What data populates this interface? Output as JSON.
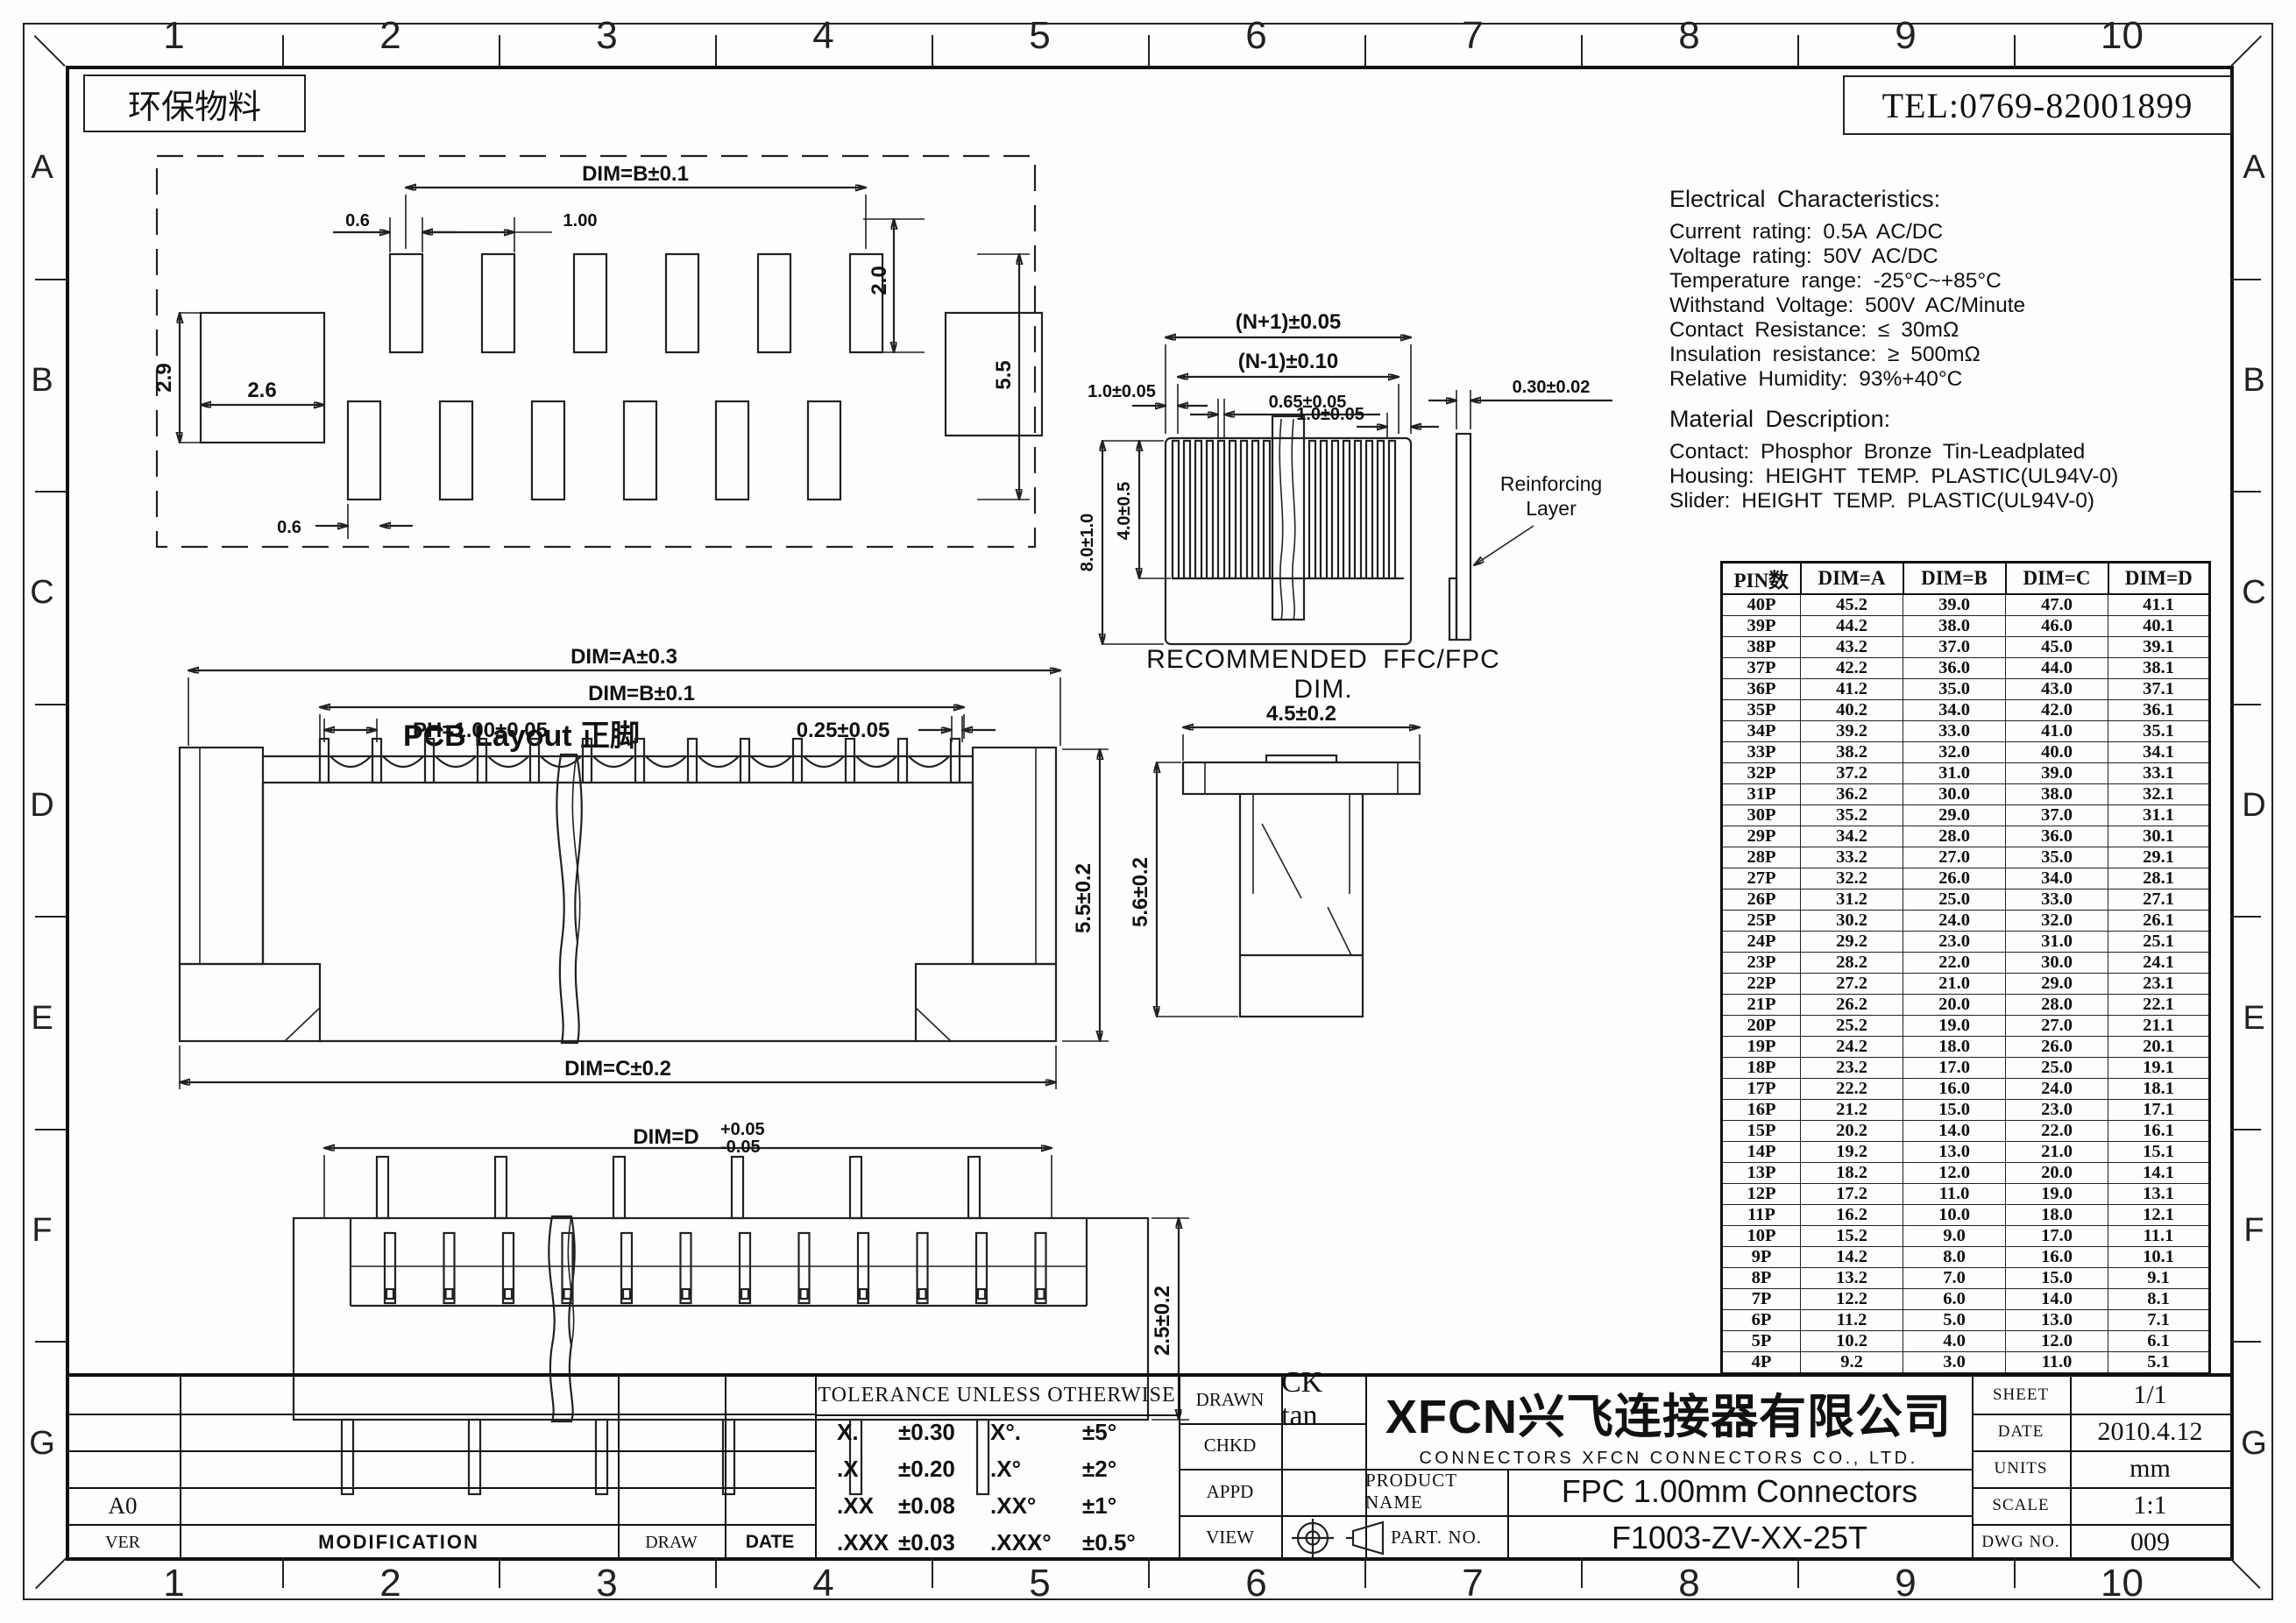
{
  "frame": {
    "columns": [
      "1",
      "2",
      "3",
      "4",
      "5",
      "6",
      "7",
      "8",
      "9",
      "10"
    ],
    "rows": [
      "A",
      "B",
      "C",
      "D",
      "E",
      "F",
      "G"
    ],
    "material_note": "环保物料",
    "tel": "TEL:0769-82001899"
  },
  "views": {
    "pcb": {
      "caption": "PCB Layout 正脚",
      "dim_b": "DIM=B±0.1",
      "d06_top": "0.6",
      "d100": "1.00",
      "d20": "2.0",
      "d26": "2.6",
      "d29": "2.9",
      "d55": "5.5",
      "d06_bottom": "0.6"
    },
    "front": {
      "dim_a": "DIM=A±0.3",
      "dim_b": "DIM=B±0.1",
      "ph": "PH=1.00±0.05",
      "d025": "0.25±0.05",
      "d55": "5.5±0.2",
      "dim_c": "DIM=C±0.2"
    },
    "bottom": {
      "dim_d": "DIM=D",
      "tol_up": "+0.05",
      "tol_dn": "-0.05",
      "d25": "2.5±0.2"
    },
    "side": {
      "d45": "4.5±0.2",
      "d56": "5.6±0.2"
    },
    "ffc": {
      "caption": "RECOMMENDED FFC/FPC DIM.",
      "np1": "(N+1)±0.05",
      "nm1": "(N-1)±0.10",
      "d10l": "1.0±0.05",
      "d065": "0.65±0.05",
      "d10r": "1.0±0.05",
      "d030": "0.30±0.02",
      "d40": "4.0±0.5",
      "d80": "8.0±1.0",
      "reinf1": "Reinforcing",
      "reinf2": "Layer"
    }
  },
  "electrical": {
    "title": "Electrical Characteristics:",
    "lines": [
      "Current rating: 0.5A AC/DC",
      "Voltage rating: 50V  AC/DC",
      "Temperature range: -25°C~+85°C",
      "Withstand Voltage: 500V AC/Minute",
      "Contact Resistance: ≤ 30mΩ",
      "Insulation resistance: ≥ 500mΩ",
      "Relative Humidity: 93%+40°C"
    ]
  },
  "material": {
    "title": "Material Description:",
    "lines": [
      "Contact: Phosphor Bronze Tin-Leadplated",
      "Housing: HEIGHT TEMP. PLASTIC(UL94V-0)",
      "Slider: HEIGHT TEMP. PLASTIC(UL94V-0)"
    ]
  },
  "pin_table": {
    "headers": [
      "PIN数",
      "DIM=A",
      "DIM=B",
      "DIM=C",
      "DIM=D"
    ],
    "rows": [
      [
        "40P",
        "45.2",
        "39.0",
        "47.0",
        "41.1"
      ],
      [
        "39P",
        "44.2",
        "38.0",
        "46.0",
        "40.1"
      ],
      [
        "38P",
        "43.2",
        "37.0",
        "45.0",
        "39.1"
      ],
      [
        "37P",
        "42.2",
        "36.0",
        "44.0",
        "38.1"
      ],
      [
        "36P",
        "41.2",
        "35.0",
        "43.0",
        "37.1"
      ],
      [
        "35P",
        "40.2",
        "34.0",
        "42.0",
        "36.1"
      ],
      [
        "34P",
        "39.2",
        "33.0",
        "41.0",
        "35.1"
      ],
      [
        "33P",
        "38.2",
        "32.0",
        "40.0",
        "34.1"
      ],
      [
        "32P",
        "37.2",
        "31.0",
        "39.0",
        "33.1"
      ],
      [
        "31P",
        "36.2",
        "30.0",
        "38.0",
        "32.1"
      ],
      [
        "30P",
        "35.2",
        "29.0",
        "37.0",
        "31.1"
      ],
      [
        "29P",
        "34.2",
        "28.0",
        "36.0",
        "30.1"
      ],
      [
        "28P",
        "33.2",
        "27.0",
        "35.0",
        "29.1"
      ],
      [
        "27P",
        "32.2",
        "26.0",
        "34.0",
        "28.1"
      ],
      [
        "26P",
        "31.2",
        "25.0",
        "33.0",
        "27.1"
      ],
      [
        "25P",
        "30.2",
        "24.0",
        "32.0",
        "26.1"
      ],
      [
        "24P",
        "29.2",
        "23.0",
        "31.0",
        "25.1"
      ],
      [
        "23P",
        "28.2",
        "22.0",
        "30.0",
        "24.1"
      ],
      [
        "22P",
        "27.2",
        "21.0",
        "29.0",
        "23.1"
      ],
      [
        "21P",
        "26.2",
        "20.0",
        "28.0",
        "22.1"
      ],
      [
        "20P",
        "25.2",
        "19.0",
        "27.0",
        "21.1"
      ],
      [
        "19P",
        "24.2",
        "18.0",
        "26.0",
        "20.1"
      ],
      [
        "18P",
        "23.2",
        "17.0",
        "25.0",
        "19.1"
      ],
      [
        "17P",
        "22.2",
        "16.0",
        "24.0",
        "18.1"
      ],
      [
        "16P",
        "21.2",
        "15.0",
        "23.0",
        "17.1"
      ],
      [
        "15P",
        "20.2",
        "14.0",
        "22.0",
        "16.1"
      ],
      [
        "14P",
        "19.2",
        "13.0",
        "21.0",
        "15.1"
      ],
      [
        "13P",
        "18.2",
        "12.0",
        "20.0",
        "14.1"
      ],
      [
        "12P",
        "17.2",
        "11.0",
        "19.0",
        "13.1"
      ],
      [
        "11P",
        "16.2",
        "10.0",
        "18.0",
        "12.1"
      ],
      [
        "10P",
        "15.2",
        "9.0",
        "17.0",
        "11.1"
      ],
      [
        "9P",
        "14.2",
        "8.0",
        "16.0",
        "10.1"
      ],
      [
        "8P",
        "13.2",
        "7.0",
        "15.0",
        "9.1"
      ],
      [
        "7P",
        "12.2",
        "6.0",
        "14.0",
        "8.1"
      ],
      [
        "6P",
        "11.2",
        "5.0",
        "13.0",
        "7.1"
      ],
      [
        "5P",
        "10.2",
        "4.0",
        "12.0",
        "6.1"
      ],
      [
        "4P",
        "9.2",
        "3.0",
        "11.0",
        "5.1"
      ]
    ]
  },
  "title_block": {
    "tolerance": {
      "header": "TOLERANCE UNLESS OTHERWISE",
      "rows": [
        [
          "X.",
          "±0.30",
          "X°.",
          "±5°"
        ],
        [
          ".X",
          "±0.20",
          ".X°",
          "±2°"
        ],
        [
          ".XX",
          "±0.08",
          ".XX°",
          "±1°"
        ],
        [
          ".XXX",
          "±0.03",
          ".XXX°",
          "±0.5°"
        ]
      ]
    },
    "sign_rows": [
      {
        "label": "DRAWN",
        "value": "CK tan"
      },
      {
        "label": "CHKD",
        "value": ""
      },
      {
        "label": "APPD",
        "value": ""
      },
      {
        "label": "VIEW",
        "value": ""
      }
    ],
    "company_cn": "XFCN兴飞连接器有限公司",
    "company_en": "CONNECTORS XFCN CONNECTORS CO., LTD.",
    "product_name_label": "PRODUCT NAME",
    "product_name": "FPC 1.00mm Connectors",
    "part_no_label": "PART. NO.",
    "part_no": "F1003-ZV-XX-25T",
    "info_rows": [
      {
        "label": "SHEET",
        "value": "1/1"
      },
      {
        "label": "DATE",
        "value": "2010.4.12"
      },
      {
        "label": "UNITS",
        "value": "mm"
      },
      {
        "label": "SCALE",
        "value": "1:1"
      },
      {
        "label": "DWG NO.",
        "value": "009"
      }
    ],
    "revision": {
      "headers": [
        "VER",
        "MODIFICATION",
        "DRAW",
        "DATE"
      ],
      "ver_value": "A0"
    }
  }
}
